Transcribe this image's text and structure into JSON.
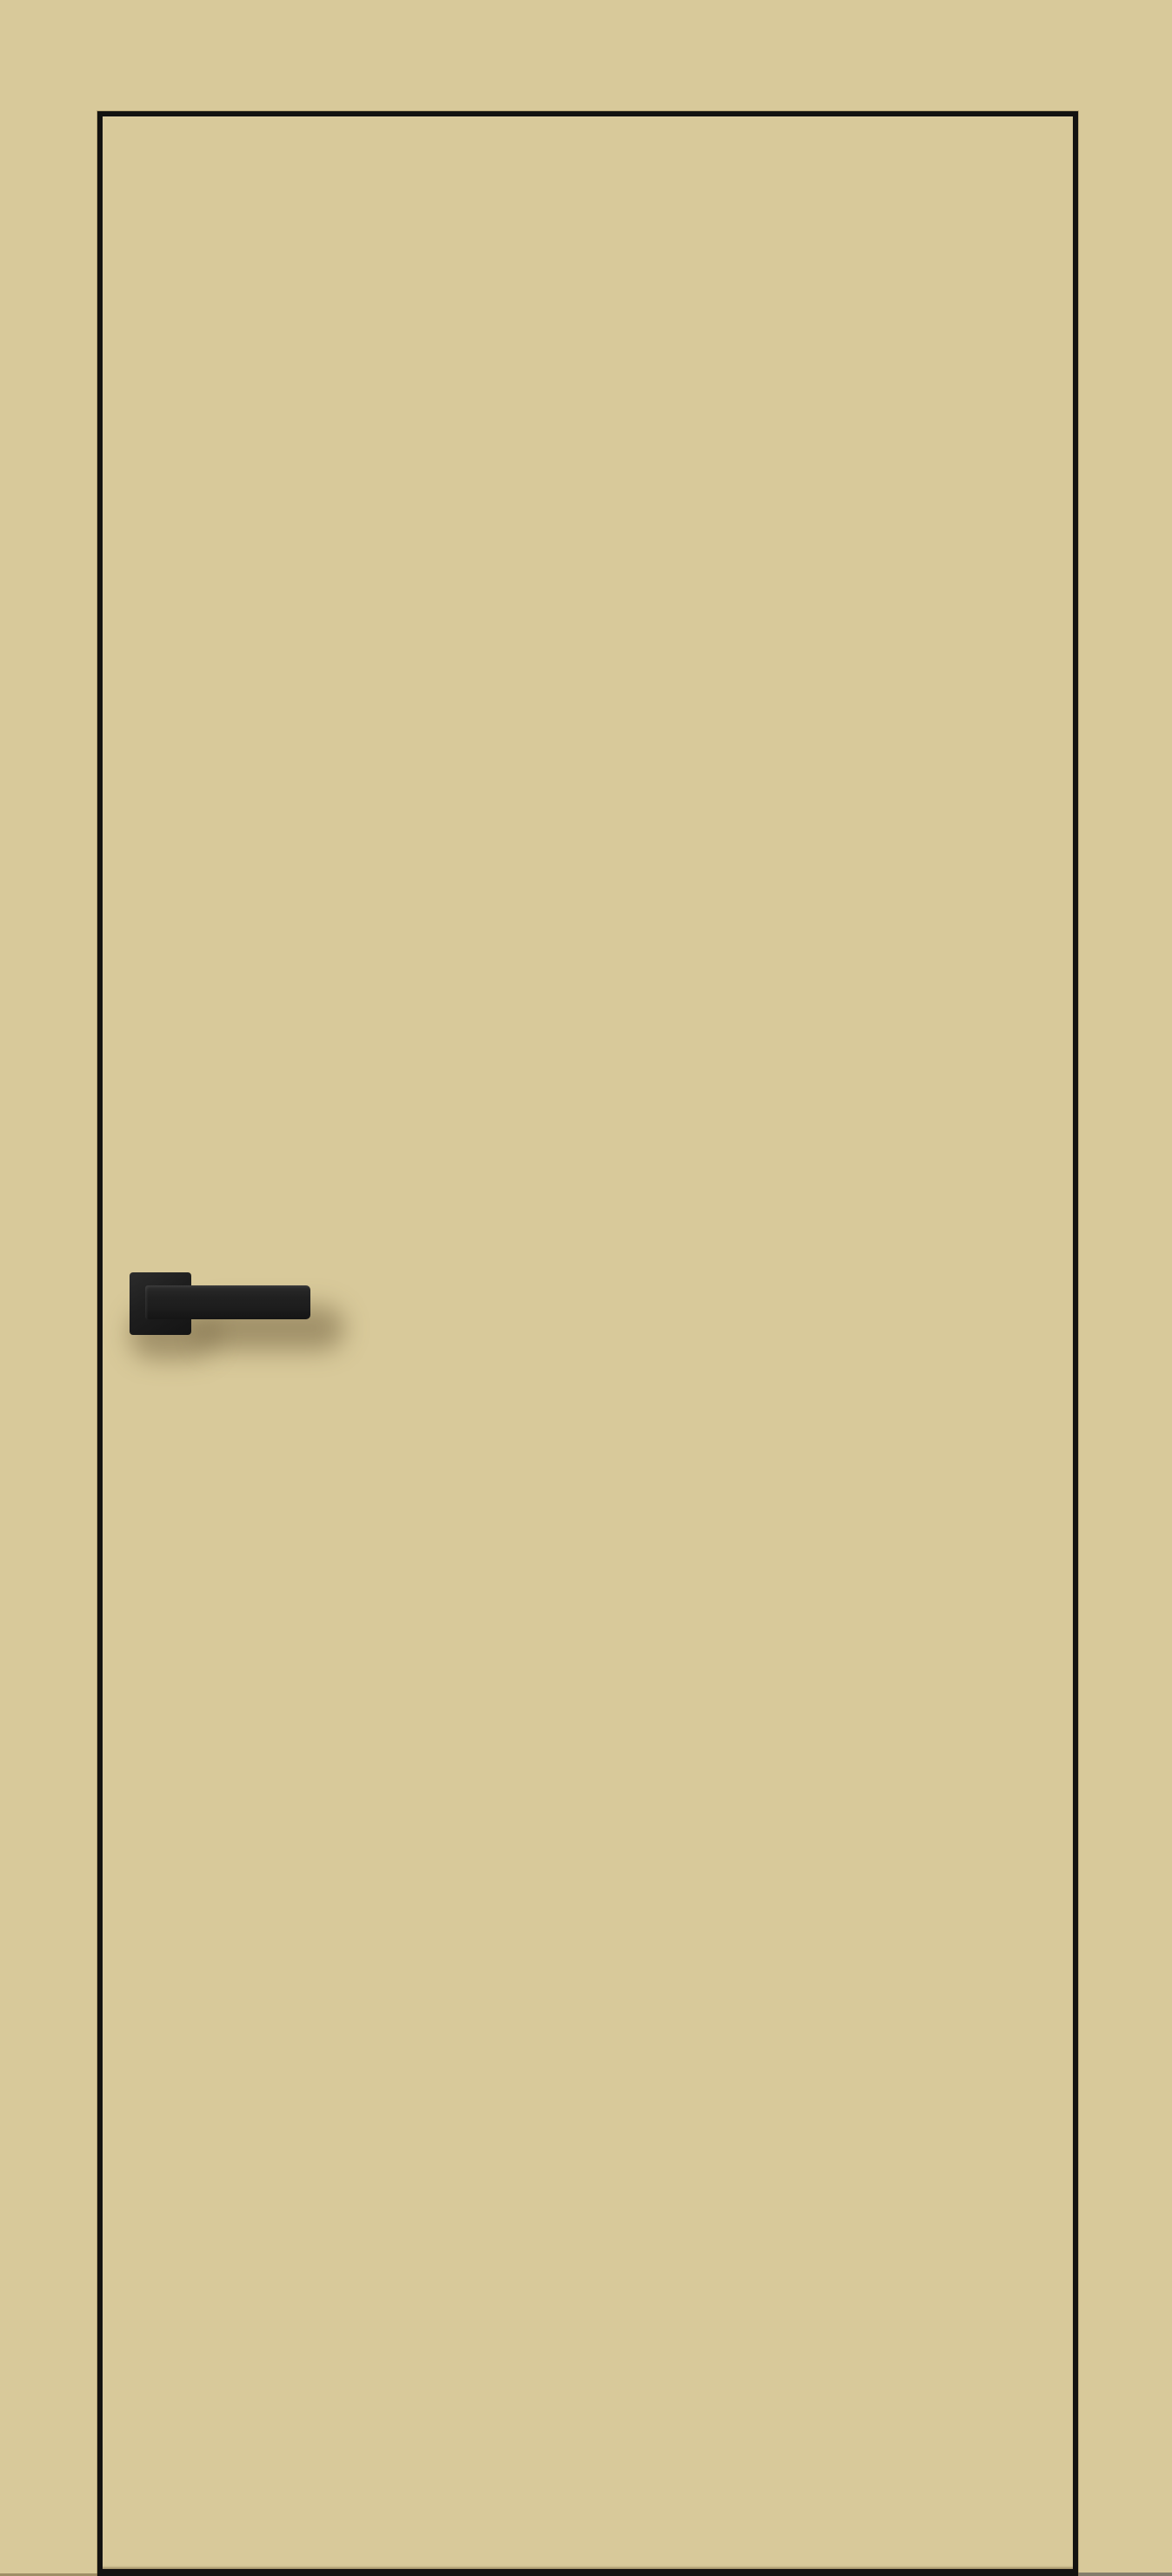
{
  "photo": {
    "subject": "Beige flush interior door with black edge trim and black square-rosette lever handle",
    "colors": {
      "background": "#d8c99a",
      "door_panel": "#d8c99a",
      "door_edge_trim": "#131210",
      "handle": "#1e1e1e",
      "handle_highlight": "#2c2c2c",
      "cast_shadow": "rgba(86,70,38,0.42)"
    },
    "elements": {
      "door": "door-leaf",
      "rosette": "square rosette",
      "lever": "straight bar lever",
      "handle_side": "left"
    }
  }
}
